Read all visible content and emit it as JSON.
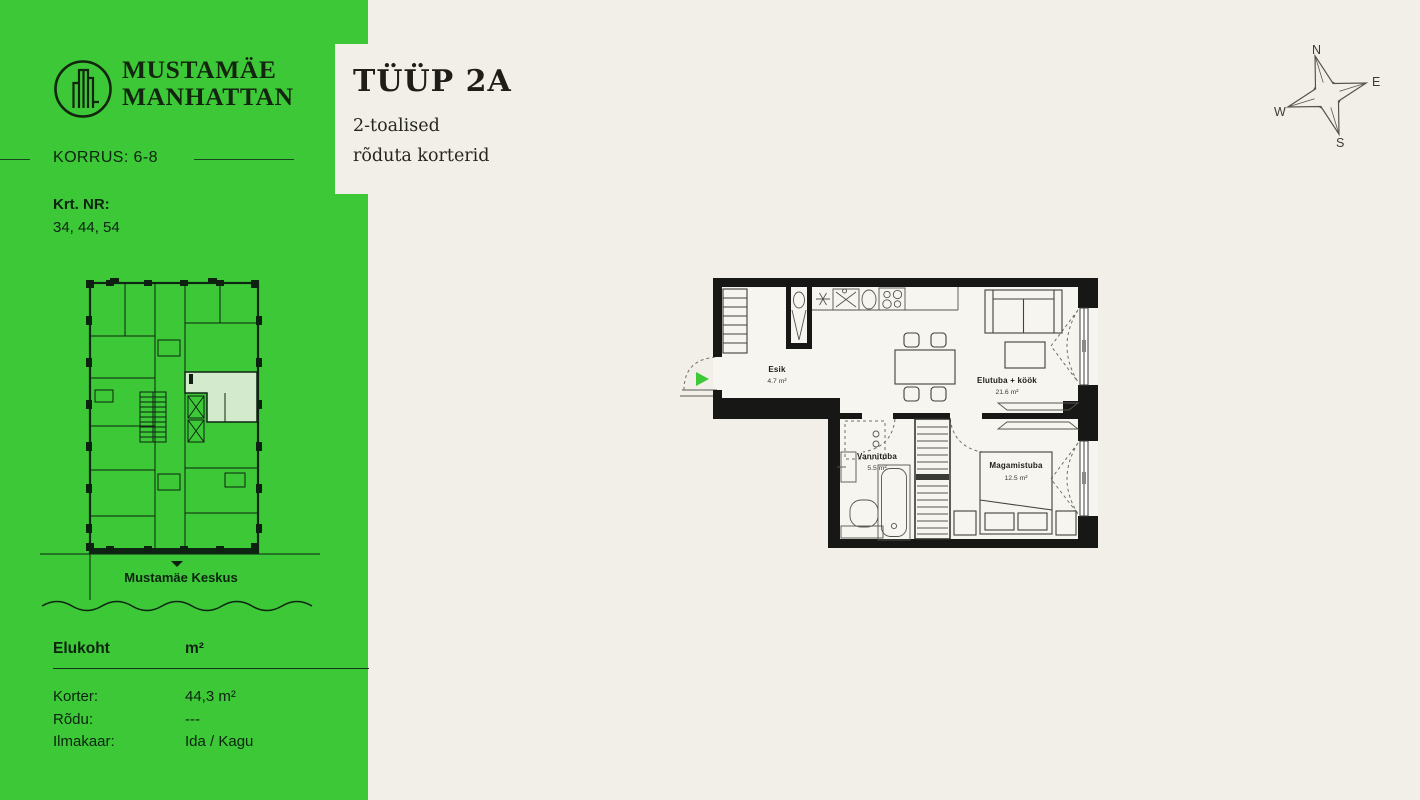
{
  "colors": {
    "sidebar_green": "#3dc837",
    "highlight_unit_green": "#d3ebcc",
    "background_cream": "#f2efe9",
    "wall_black": "#171715",
    "ink_dark": "#0c2310"
  },
  "sidebar": {
    "brand_line1": "MUSTAMÄE",
    "brand_line2": "MANHATTAN",
    "korrus": "KORRUS: 6-8",
    "krt_label": "Krt. NR:",
    "krt_numbers": "34, 44, 54",
    "miniplan_caption": "Mustamäe Keskus",
    "table": {
      "header_col1": "Elukoht",
      "header_col2": "m²",
      "rows": [
        {
          "label": "Korter:",
          "value": "44,3 m²"
        },
        {
          "label": "Rõdu:",
          "value": "---"
        },
        {
          "label": "Ilmakaar:",
          "value": "Ida / Kagu"
        }
      ]
    }
  },
  "header": {
    "title": "TÜÜP 2A",
    "subtitle_line1": "2-toalised",
    "subtitle_line2": "rõduta korterid"
  },
  "compass": {
    "n": "N",
    "e": "E",
    "s": "S",
    "w": "W"
  },
  "floorplan": {
    "rooms": [
      {
        "name": "Esik",
        "area": "4.7 m²"
      },
      {
        "name": "Elutuba + köök",
        "area": "21.6 m²"
      },
      {
        "name": "Vannituba",
        "area": "5.5 m²"
      },
      {
        "name": "Magamistuba",
        "area": "12.5 m²"
      }
    ]
  }
}
